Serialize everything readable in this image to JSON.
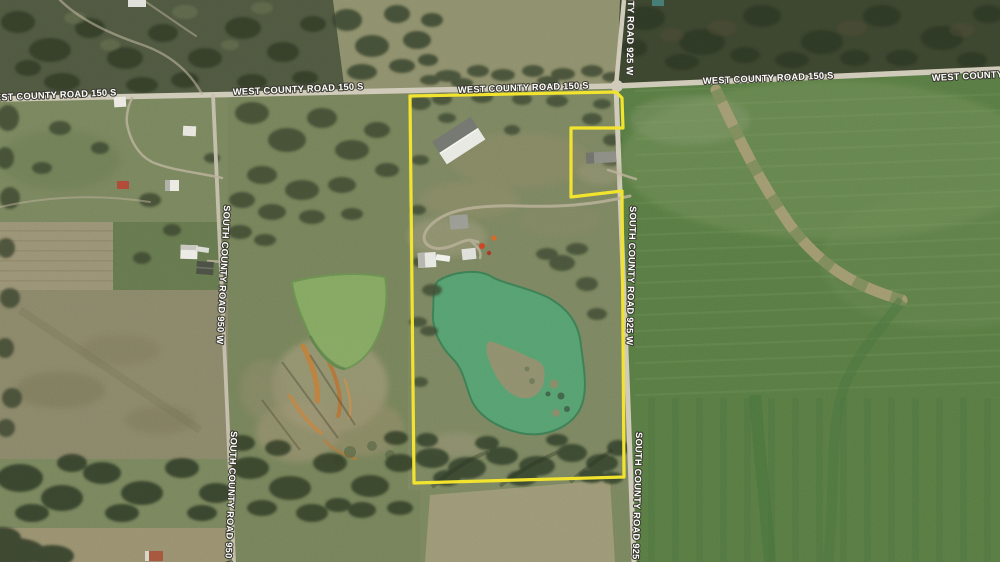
{
  "map": {
    "view": "satellite",
    "roads": {
      "west_county_road_150s": "WEST COUNTY ROAD 150 S",
      "south_county_road_925w": "SOUTH COUNTY ROAD 925 W",
      "south_county_road_950w": "SOUTH COUNTY ROAD 950 W"
    },
    "label_style": {
      "text_color": "#ffffff",
      "outline_color": "#3a392f"
    },
    "boundary": {
      "color": "#f2e42e",
      "points": "410,96 616,92 622,98 623,128 571,128 571,197 622,191 624,477 414,483"
    },
    "features": {
      "road_color": "#cfc9b8",
      "left_road_color": "#c6c0ae",
      "driveway_color": "#b9b098",
      "field_green": "#587b43",
      "forest_dark": "#3c452f",
      "pond_main_color": "#55a171",
      "pond_west_color": "#85aa62",
      "quarry_orange": "#c47c35"
    }
  }
}
